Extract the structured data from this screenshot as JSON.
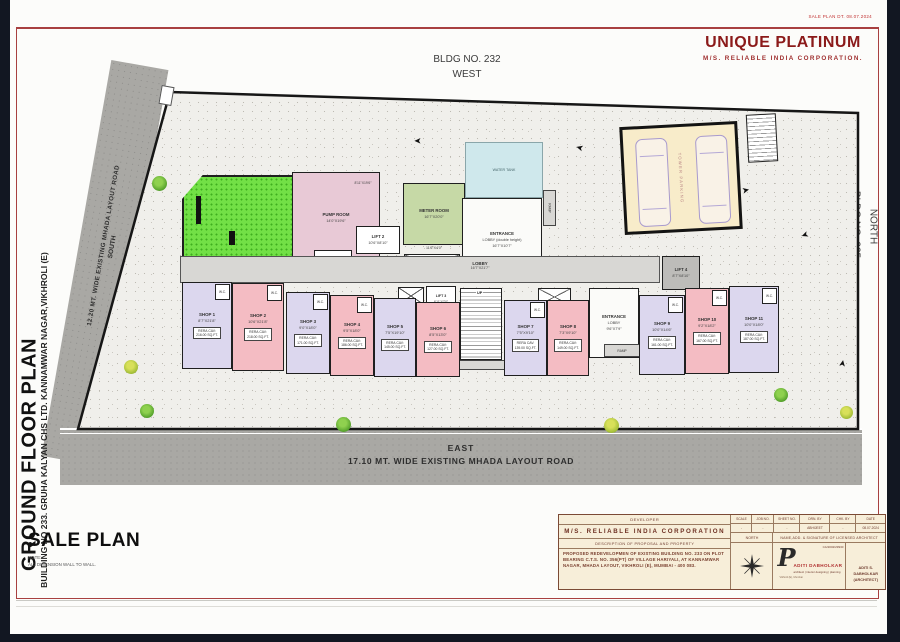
{
  "colors": {
    "frame": "#121722",
    "sheet": "#fcfcfa",
    "maroon": "#8b1a1a",
    "road": "#a9a8a4",
    "plot": "#f0efeb",
    "green_open": "#72e046",
    "lavender": "#dcd7ee",
    "pink": "#f4bcc3",
    "pump": "#e8c9d6",
    "meter": "#c6d9a6",
    "tank": "#cfe8ec",
    "parking_bg": "#f8ecca",
    "corridor": "#d8d7d4",
    "block_bg": "#f7eed9"
  },
  "header": {
    "stamp": "SALE PLAN DT. 08.07.2024",
    "title": "UNIQUE PLATINUM",
    "subtitle": "M/S.  RELIABLE  INDIA  CORPORATION."
  },
  "orientation": {
    "top_bldg": "BLDG NO. 232",
    "top_dir": "WEST",
    "right_bldg": "BLDG NO. 235",
    "right_dir": "NORTH"
  },
  "roads": {
    "south_label": "12.20 MT. WIDE EXISTING MHADA LAYOUT ROAD",
    "south_dir": "SOUTH",
    "east_dir": "EAST",
    "east_label": "17.10 MT. WIDE EXISTING MHADA LAYOUT ROAD"
  },
  "side_titles": {
    "main": "GROUND FLOOR PLAN",
    "sub": "BUILDING NO 233. GRUHA KALYAN CHS LTD. KANNAMWAR NAGAR,VIKHROLI (E)"
  },
  "sale_plan": {
    "title": "SALE PLAN",
    "note_label": "NOTE:",
    "note": "ALL DIMENSION WALL TO WALL."
  },
  "plan": {
    "wc_label": "W.C.",
    "rera_label": "RERA CAV:",
    "stair_up": "UP",
    "ramp_label": "RAMP",
    "parking_label": "TOWER PARKING",
    "rooms": {
      "pump": {
        "name": "PUMP ROOM",
        "dims": "14'0\"X19'6\"",
        "extra_dim": "8'11\"X19'6\""
      },
      "meter": {
        "name": "METER ROOM",
        "dims": "16'7\"X20'0\"",
        "below_dim": "11'6\"X4'0\""
      },
      "tank": {
        "name": "WATER TANK"
      },
      "entrance1": {
        "l1": "ENTRANCE",
        "l2": "LOBBY (double height)",
        "dims": "16'7\"X10'7\""
      },
      "lobby": {
        "name": "LOBBY",
        "dims": "16'7\"X21'7\""
      },
      "entrance2": {
        "l1": "ENTRANCE",
        "l2": "LOBBY",
        "dims": "9'6\"X7'9\""
      },
      "lift1": {
        "name": "LIFT 1",
        "dims": "8'4\"X8'10\""
      },
      "lift2": {
        "name": "LIFT 2",
        "dims": "10'6\"X8'10\""
      },
      "lift3": {
        "name": "LIFT 3",
        "dims": "6'11\"X7'0\""
      },
      "lift4": {
        "name": "LIFT 4",
        "dims": "8'7\"X8'10\""
      }
    },
    "shops": [
      {
        "name": "SHOP 1",
        "dims": "8'7\"X21'8\"",
        "area": "216.00 SQ.FT.",
        "color": "#dcd7ee"
      },
      {
        "name": "SHOP 2",
        "dims": "10'6\"X21'8\"",
        "area": "218.00 SQ.FT.",
        "color": "#f4bcc3"
      },
      {
        "name": "SHOP 3",
        "dims": "9'0\"X18'0\"",
        "area": "171.00 SQ.FT.",
        "color": "#dcd7ee"
      },
      {
        "name": "SHOP 4",
        "dims": "9'5\"X18'0\"",
        "area": "186.00 SQ.FT.",
        "color": "#f4bcc3"
      },
      {
        "name": "SHOP 5",
        "dims": "7'5\"X19'10\"",
        "area": "145.00 SQ.FT.",
        "color": "#dcd7ee"
      },
      {
        "name": "SHOP 6",
        "dims": "8'5\"X13'0\"",
        "area": "127.00 SQ.FT.",
        "color": "#f4bcc3"
      },
      {
        "name": "SHOP 7",
        "dims": "7'5\"X9'10\"",
        "area": "139.00 SQ.FT.",
        "color": "#dcd7ee"
      },
      {
        "name": "SHOP 8",
        "dims": "7'3\"X9'10\"",
        "area": "149.00 SQ.FT.",
        "color": "#f4bcc3"
      },
      {
        "name": "SHOP 9",
        "dims": "10'0\"X14'6\"",
        "area": "161.00 SQ.FT.",
        "color": "#dcd7ee"
      },
      {
        "name": "SHOP 10",
        "dims": "9'2\"X18'2\"",
        "area": "167.00 SQ.FT.",
        "color": "#f4bcc3"
      },
      {
        "name": "SHOP 11",
        "dims": "10'0\"X18'0\"",
        "area": "187.00 SQ.FT.",
        "color": "#dcd7ee"
      }
    ]
  },
  "titleblock": {
    "developer_label": "DEVELOPER",
    "developer": "M/S.  RELIABLE  INDIA  CORPORATION",
    "description_label": "DESCRIPTION OF PROPOSAL AND PROPERTY",
    "description": "PROPOSED REDEVELOPMEN OF EXISTING BUILDING NO. 233 ON PLOT BEARING C.T.S. NO. 356(PT) OF VILLAGE HARIYALI, AT KANNAMWAR NAGAR, MHADA LAYOUT, VIKHROLI (E), MUMBAI - 400 083.",
    "cols": {
      "scale": "SCALE",
      "job": "JOB NO.",
      "sheet": "SHEET NO.",
      "drn": "DRN. BY",
      "chk": "CHK. BY",
      "date": "DATE"
    },
    "vals": {
      "scale": "-",
      "job": "-",
      "sheet": "-",
      "drn": "ABHIJEET",
      "chk": "-",
      "date": "08.07.2024"
    },
    "north_label": "NORTH",
    "architect_row_label": "NAME,ADD. & SIGNATURE OF LICENSED ARCHITECT",
    "reg_no": "CA/2002/29930",
    "signature": "P",
    "architect_name": "ADITI DABHOLKAR",
    "architect_tagline": "architect | interior designing | planning",
    "architect_addr": "Vikhroli (E), Mumbai",
    "architect_right1": "ADITI S. DABHOLKAR",
    "architect_right2": "(ARCHITECT)"
  }
}
